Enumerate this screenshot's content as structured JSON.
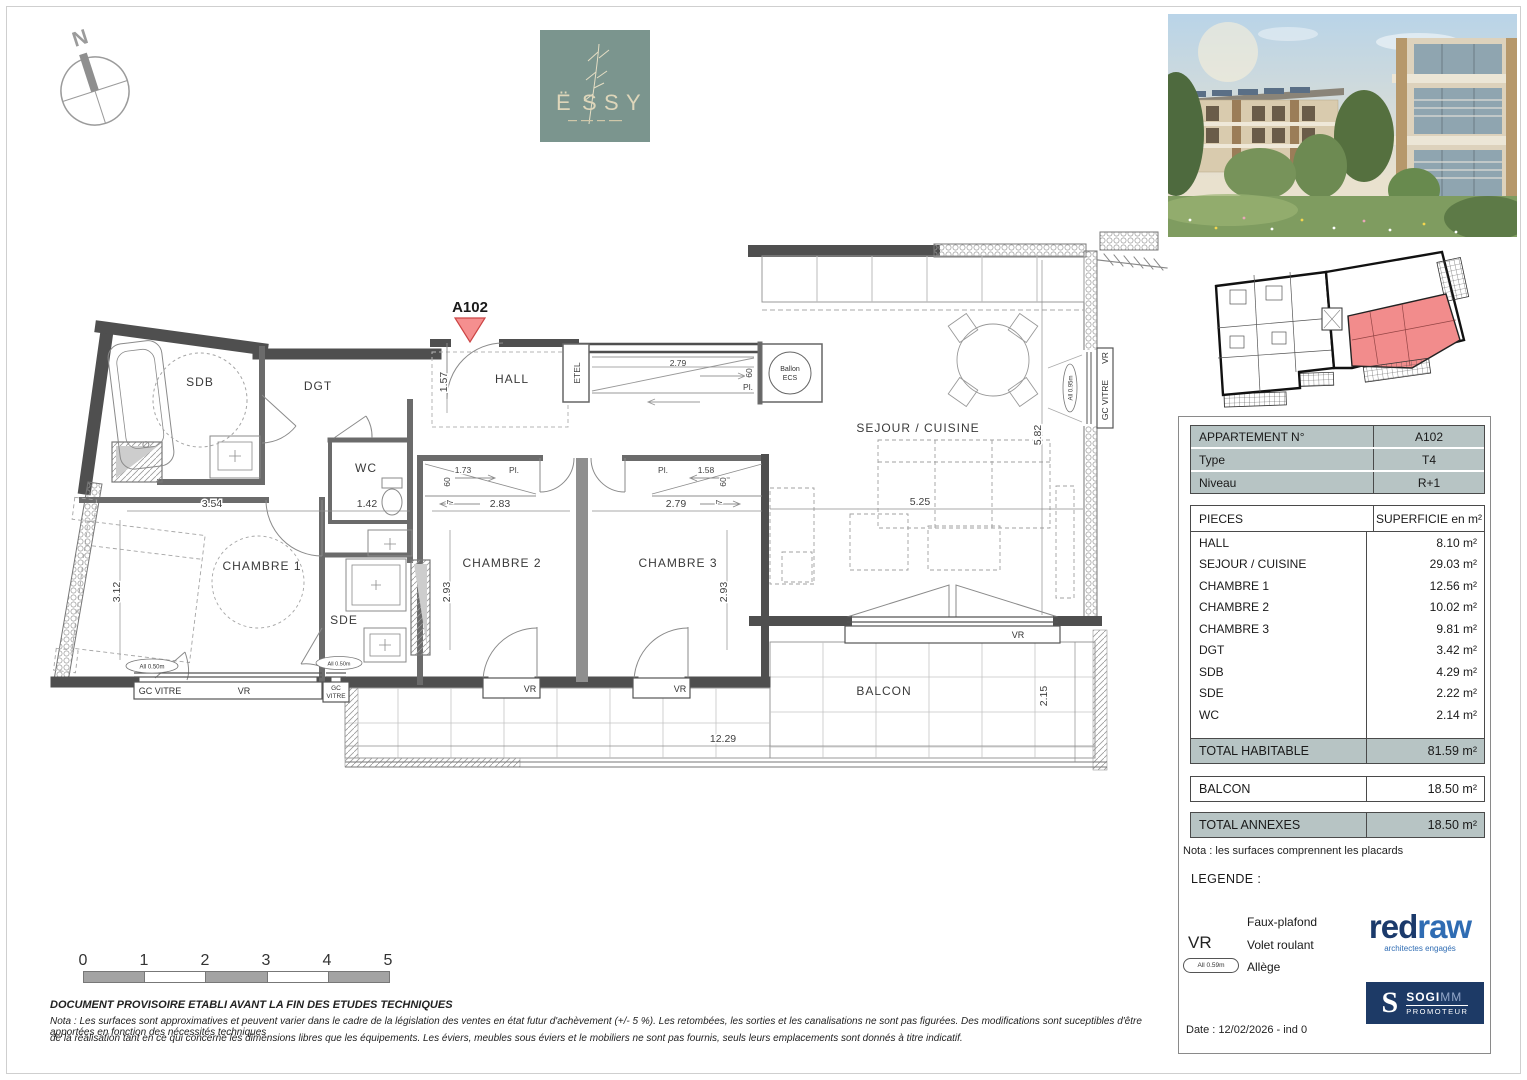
{
  "compass": {
    "label": "N"
  },
  "brand": {
    "letters": [
      "Ë",
      "S",
      "S",
      "Y"
    ]
  },
  "plan": {
    "marker": "A102",
    "rooms": {
      "sdb": "SDB",
      "dgt": "DGT",
      "hall": "HALL",
      "wc": "WC",
      "chambre1": "CHAMBRE 1",
      "chambre2": "CHAMBRE 2",
      "chambre3": "CHAMBRE 3",
      "sde": "SDE",
      "sejour": "SEJOUR / CUISINE",
      "balcon": "BALCON"
    },
    "labels": {
      "etel": "ETEL",
      "ballon1": "Ballon",
      "ballon2": "ECS",
      "gc_vitre": "GC VITRE",
      "gc": "GC",
      "vitre": "VITRE",
      "vr": "VR",
      "pl": "Pl."
    },
    "dims": {
      "hall": "1.57",
      "corridor": "2.79",
      "sixty": "60",
      "seven": "7",
      "closet2": "1.73",
      "closet3": "1.58",
      "ch1w": "3.54",
      "wc": "1.42",
      "ch1h": "3.12",
      "ch2w": "2.83",
      "ch3w": "2.79",
      "ch23h": "2.93",
      "sejw": "5.25",
      "sejh": "5.82",
      "balw": "12.29",
      "balh": "2.15"
    },
    "alleges": {
      "left": "All 0.50m",
      "mid": "All 0.50m",
      "right": "All 0.95m"
    }
  },
  "panel": {
    "info": {
      "rows": [
        {
          "label": "APPARTEMENT N°",
          "value": "A102"
        },
        {
          "label": "Type",
          "value": "T4"
        },
        {
          "label": "Niveau",
          "value": "R+1"
        }
      ]
    },
    "pieces": {
      "header_label": "PIECES",
      "header_value": "SUPERFICIE en m²",
      "rows": [
        {
          "label": "HALL",
          "value": "8.10 m²"
        },
        {
          "label": "SEJOUR / CUISINE",
          "value": "29.03 m²"
        },
        {
          "label": "CHAMBRE 1",
          "value": "12.56 m²"
        },
        {
          "label": "CHAMBRE 2",
          "value": "10.02 m²"
        },
        {
          "label": "CHAMBRE 3",
          "value": "9.81 m²"
        },
        {
          "label": "DGT",
          "value": "3.42 m²"
        },
        {
          "label": "SDB",
          "value": "4.29 m²"
        },
        {
          "label": "SDE",
          "value": "2.22 m²"
        },
        {
          "label": "WC",
          "value": "2.14 m²"
        }
      ]
    },
    "totals": {
      "habitable": {
        "label": "TOTAL HABITABLE",
        "value": "81.59 m²"
      },
      "balcon": {
        "label": "BALCON",
        "value": "18.50 m²"
      },
      "annexes": {
        "label": "TOTAL ANNEXES",
        "value": "18.50 m²"
      }
    },
    "nota": "Nota : les surfaces comprennent les placards",
    "legend": {
      "title": "LEGENDE :",
      "items": [
        {
          "symbol": "",
          "label": "Faux-plafond"
        },
        {
          "symbol": "VR",
          "label": "Volet roulant"
        },
        {
          "symbol": "All 0.59m",
          "label": "Allège"
        }
      ]
    },
    "logos": {
      "redraw_part1": "red",
      "redraw_part2": "raw",
      "redraw_tagline": "architectes engagés",
      "sogimm_initial": "S",
      "sogimm_name": "SOGI",
      "sogimm_name2": "MM",
      "sogimm_sub": "PROMOTEUR"
    },
    "date": "Date : 12/02/2026 - ind 0"
  },
  "scalebar": {
    "labels": [
      "0",
      "1",
      "2",
      "3",
      "4",
      "5"
    ]
  },
  "footer": {
    "line1": "DOCUMENT PROVISOIRE ETABLI AVANT LA FIN DES ETUDES TECHNIQUES",
    "line2": "Nota : Les surfaces sont approximatives et peuvent varier dans le cadre de la législation des ventes en état futur d'achèvement (+/- 5 %). Les retombées, les sorties et les canalisations ne sont pas figurées. Des modifications sont suceptibles d'être apportées en fonction des nécessités techniques",
    "line3": "de la réalisation tant en ce qui concerne les dimensions libres que les équipements. Les éviers, meubles sous éviers et le mobiliers ne sont pas fournis, seuls leurs emplacements sont donnés à titre indicatif."
  },
  "colors": {
    "accent_red": "#f28b8b",
    "table_header": "#b7c4c4",
    "brand_green": "#7b958e",
    "redraw_dark": "#1b3a6b",
    "redraw_light": "#2f6cb3",
    "sogimm_navy": "#1d3a66"
  }
}
